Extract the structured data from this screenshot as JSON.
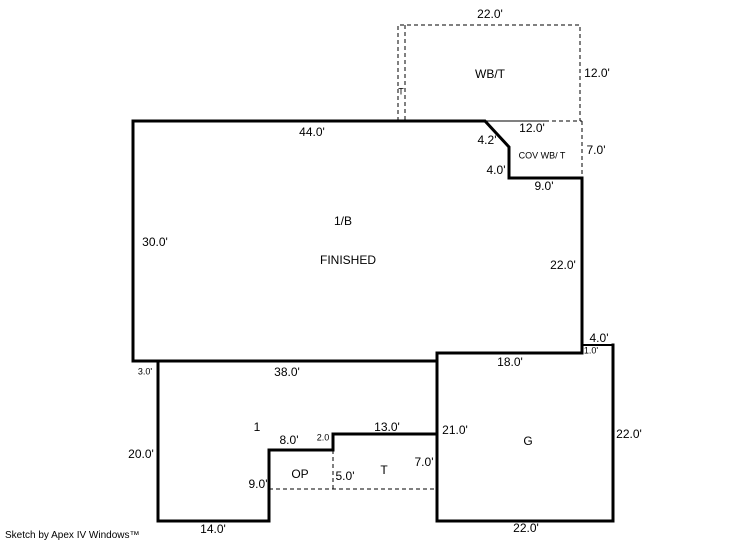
{
  "sketch": {
    "footer_credit": "Sketch by Apex IV Windows™",
    "areas": {
      "wbt": {
        "name": "WB/T",
        "t_strip": "T",
        "top": "22.0'",
        "right": "12.0'"
      },
      "cov": {
        "name": "COV WB/ T",
        "diagonal": "4.2'",
        "top": "12.0'",
        "right": "7.0'",
        "left": "4.0'",
        "bottom": "9.0'"
      },
      "main": {
        "name_line1": "1/B",
        "name_line2": "FINISHED",
        "top": "44.0'",
        "left": "30.0'",
        "right": "22.0'",
        "bottom": "38.0'",
        "left_offset": "3.0'"
      },
      "area1": {
        "name": "1",
        "left": "20.0'",
        "bottom": "14.0'"
      },
      "op": {
        "name": "OP",
        "top": "8.0'",
        "left": "9.0'",
        "right": "5.0'",
        "step": "2.0"
      },
      "t": {
        "name": "T",
        "top": "13.0'",
        "right": "7.0'"
      },
      "g": {
        "name": "G",
        "top": "18.0'",
        "left": "21.0'",
        "right": "22.0'",
        "bottom": "22.0'",
        "jog_top": "4.0'",
        "jog_right": "1.0'"
      }
    }
  }
}
